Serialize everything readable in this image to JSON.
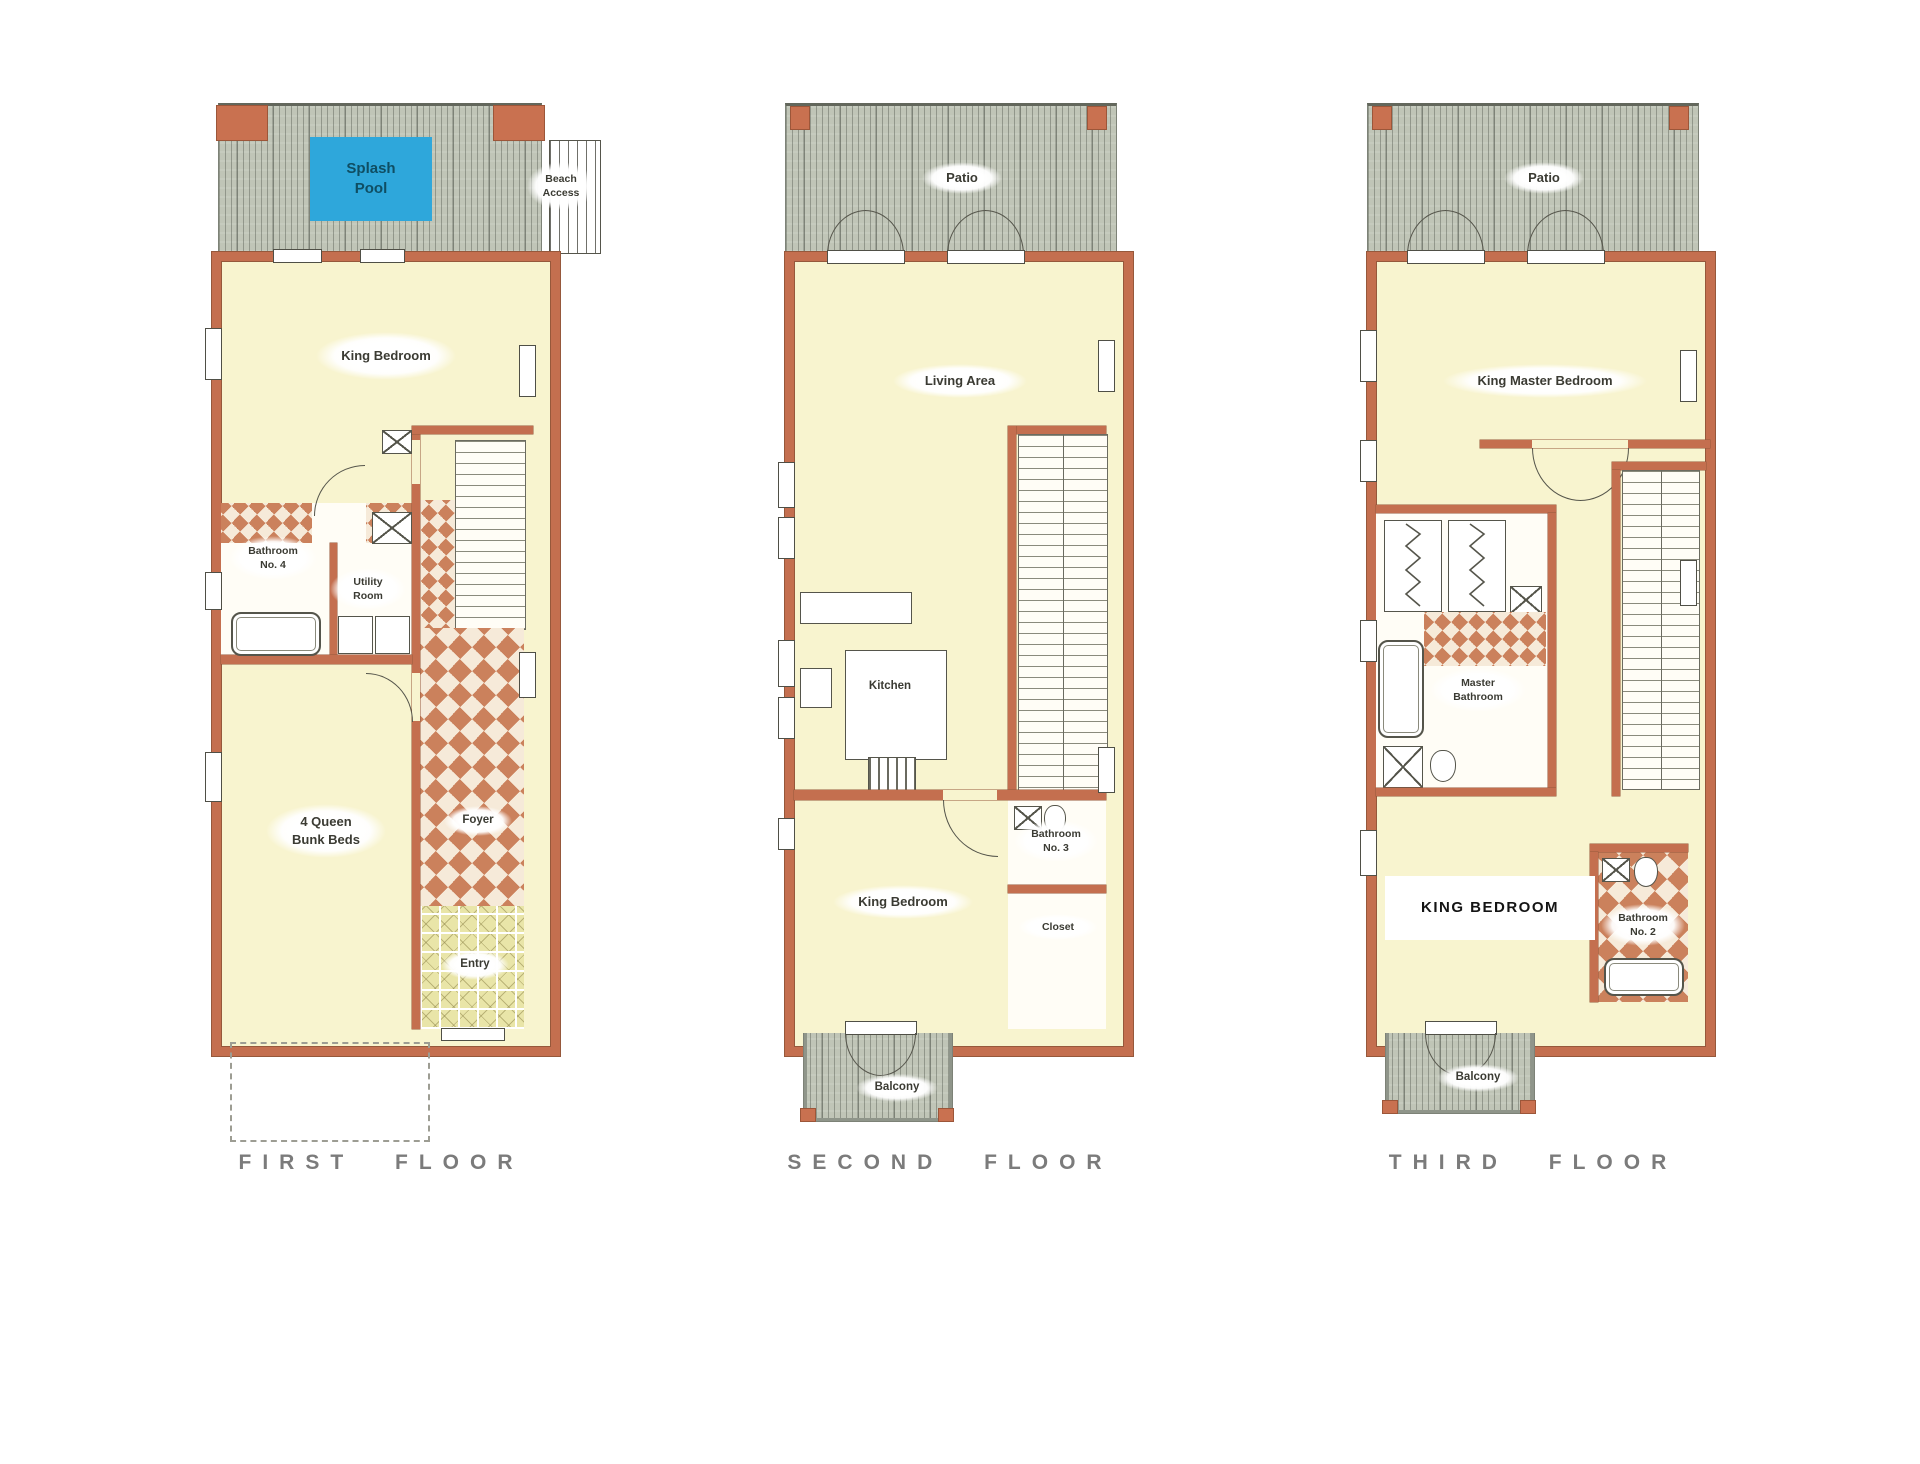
{
  "document": {
    "kind": "three-story beach house floor plan",
    "background": "#ffffff"
  },
  "colors": {
    "wall": "#c46f4f",
    "room_fill": "#f8f4cf",
    "deck": "#c0c5b7",
    "pool_blue": "#2ea7db",
    "tile_terracotta": "#cb815c",
    "tile_entry": "#e9e5a8",
    "label_text": "#3b3b33",
    "floor_title_gray": "#7b7b7b"
  },
  "floors": [
    {
      "title": "FIRST FLOOR",
      "rooms": {
        "splash_pool": "Splash\nPool",
        "beach_access": "Beach\nAccess",
        "king_bedroom": "King Bedroom",
        "bathroom_no4": "Bathroom\nNo. 4",
        "utility_room": "Utility\nRoom",
        "bunk_room": "4 Queen\nBunk Beds",
        "foyer": "Foyer",
        "entry": "Entry"
      }
    },
    {
      "title": "SECOND FLOOR",
      "rooms": {
        "patio": "Patio",
        "living_area": "Living Area",
        "kitchen": "Kitchen",
        "king_bedroom": "King Bedroom",
        "bathroom_no3": "Bathroom\nNo. 3",
        "closet": "Closet",
        "balcony": "Balcony"
      }
    },
    {
      "title": "THIRD FLOOR",
      "rooms": {
        "patio": "Patio",
        "king_master_bedroom": "King Master Bedroom",
        "master_bathroom": "Master\nBathroom",
        "king_bedroom": "KING BEDROOM",
        "bathroom_no2": "Bathroom\nNo. 2",
        "balcony": "Balcony"
      }
    }
  ]
}
